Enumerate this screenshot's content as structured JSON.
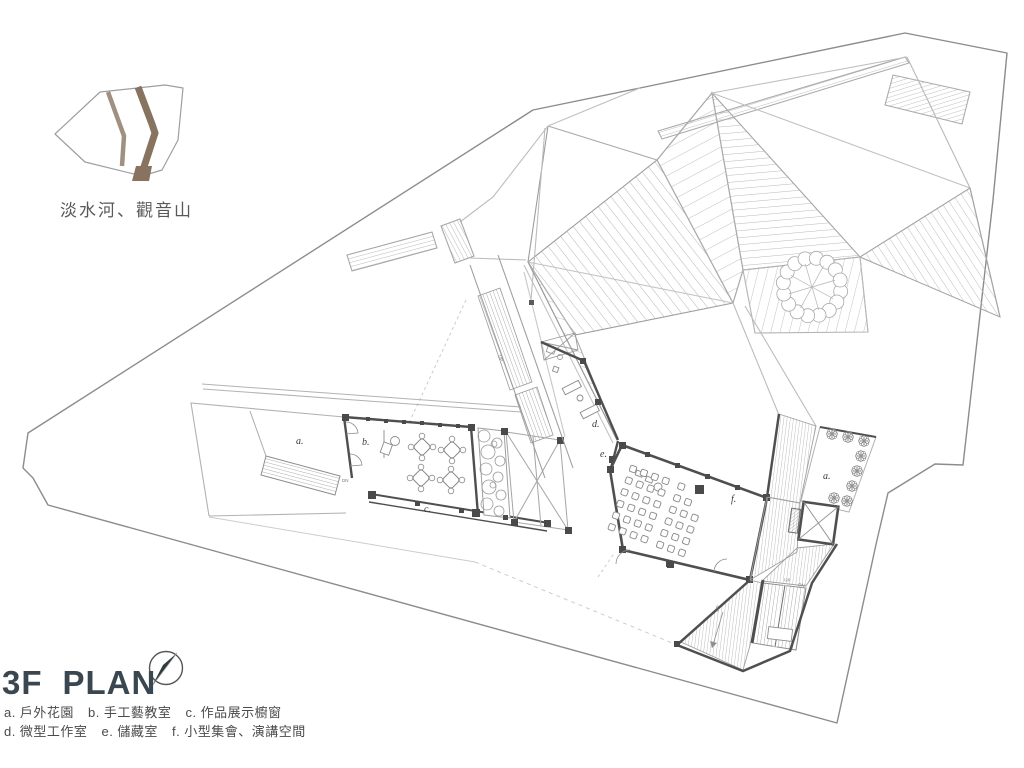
{
  "site_map": {
    "label": "淡水河、觀音山"
  },
  "title": {
    "floor": "3F",
    "plan": "PLAN"
  },
  "legend": {
    "rows": [
      [
        {
          "key": "a.",
          "label": "戶外花園"
        },
        {
          "key": "b.",
          "label": "手工藝教室"
        },
        {
          "key": "c.",
          "label": "作品展示櫥窗"
        }
      ],
      [
        {
          "key": "d.",
          "label": "微型工作室"
        },
        {
          "key": "e.",
          "label": "儲藏室"
        },
        {
          "key": "f.",
          "label": "小型集會、演講空間"
        }
      ]
    ]
  },
  "plan": {
    "room_labels": {
      "garden_left": "a.",
      "craft_room": "b.",
      "display_window": "c.",
      "micro_studio": "d.",
      "storage": "e.",
      "assembly": "f.",
      "garden_right": "a."
    },
    "stair_labels": {
      "up": "UP",
      "dn": "DN"
    }
  },
  "colors": {
    "wall": "#4f4f4f",
    "light_line": "#b2b2b2",
    "site_boundary": "#8c8c8c",
    "river_band_light": "#a09080",
    "river_band_dark": "#87735f",
    "title_text": "#3b4750",
    "legend_text": "#4b4b4b",
    "north_needle": "#2f3a3d"
  }
}
